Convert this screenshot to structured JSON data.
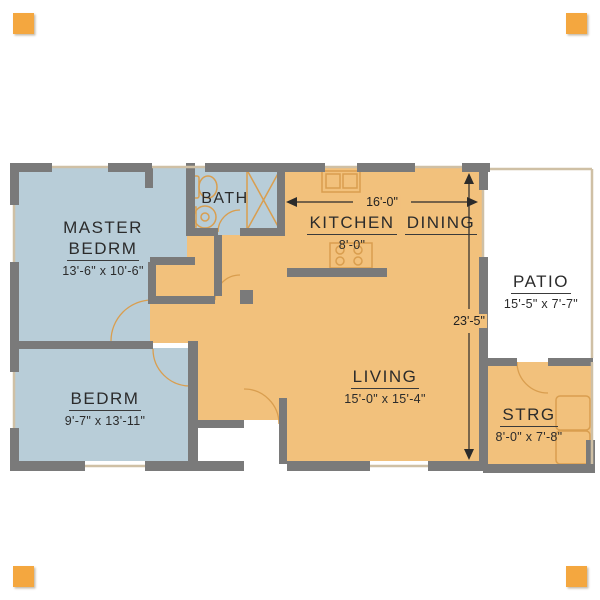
{
  "canvas": {
    "width": 600,
    "height": 600,
    "background": "#ffffff"
  },
  "colors": {
    "room_orange": "#f2c17c",
    "room_blue": "#b8cdd8",
    "wall_gray": "#7a7a7a",
    "fixture_line": "#d99e4f",
    "window_line": "#cfc0a5",
    "label_text": "#2b2b2b",
    "corner_marker": "#f4a73f"
  },
  "rooms": {
    "master": {
      "line1": "MASTER",
      "line2": "BEDRM",
      "dims": "13'-6\" x 10'-6\""
    },
    "bedroom": {
      "label": "BEDRM",
      "dims": "9'-7\" x 13'-11\""
    },
    "bath": {
      "label": "BATH"
    },
    "kitchen": {
      "label": "KITCHEN",
      "dims": "8'-0\""
    },
    "dining": {
      "label": "DINING"
    },
    "living": {
      "label": "LIVING",
      "dims": "15'-0\" x 15'-4\""
    },
    "patio": {
      "label": "PATIO",
      "dims": "15'-5\" x 7'-7\""
    },
    "storage": {
      "label": "STRG",
      "dims": "8'-0\" x 7'-8\""
    }
  },
  "dimensions": {
    "overall_width": "16'-0\"",
    "overall_height": "23'-5\""
  }
}
